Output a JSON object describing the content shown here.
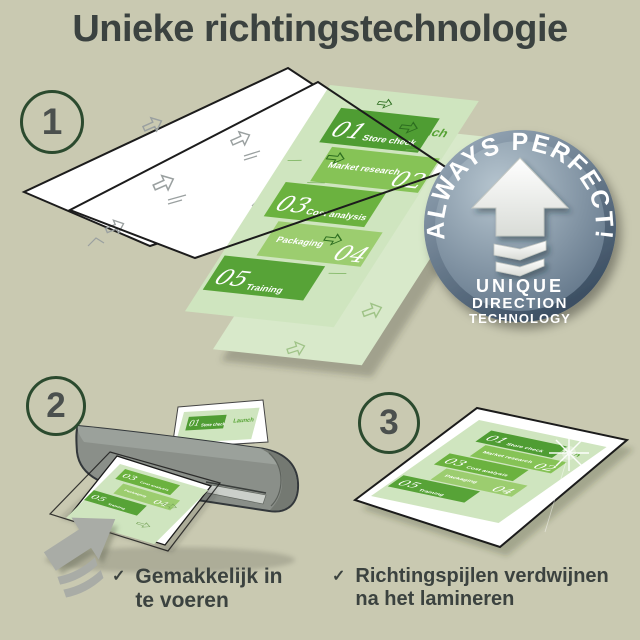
{
  "page": {
    "title": "Unieke richtingstechnologie"
  },
  "steps": {
    "one": "1",
    "two": "2",
    "three": "3"
  },
  "badge": {
    "arc_text": "ALWAYS PERFECT!",
    "line1": "UNIQUE",
    "line2": "DIRECTION",
    "line3": "TECHNOLOGY"
  },
  "flyer": {
    "launch": "Launch",
    "items": [
      {
        "num": "01",
        "label": "Store check"
      },
      {
        "num": "02",
        "label": "Market research"
      },
      {
        "num": "03",
        "label": "Cost analysis"
      },
      {
        "num": "04",
        "label": "Packaging"
      },
      {
        "num": "05",
        "label": "Training"
      }
    ]
  },
  "checks": {
    "mark": "✓",
    "item1": {
      "line1": "Gemakkelijk in",
      "line2": "te voeren"
    },
    "item2": {
      "line1": "Richtingspijlen verdwijnen",
      "line2": "na het lamineren"
    }
  },
  "colors": {
    "background": "#c9c9b1",
    "title_text": "#3b4240",
    "circle_border": "#2b4a2e",
    "step_number": "#4b504e",
    "check_text": "#3b423f",
    "flyer_bg": "#cfe5bf",
    "pale_sheet": "#d8e9ca",
    "block_01": "#4f9d33",
    "block_02": "#86c356",
    "block_03": "#6bb23f",
    "block_04": "#9ccd6f",
    "block_05": "#57a337",
    "launch_green": "#55a233",
    "badge_rim_dark": "#3c4f63",
    "badge_face": "#5d7185",
    "badge_text": "#ffffff",
    "badge_arrow": "#f4f4f1",
    "laminator_gray": "#8a8f89",
    "silver": "#cbcfca",
    "feed_arrow_gray": "#a9aca6",
    "watermark_gray": "#9aa0a0"
  }
}
